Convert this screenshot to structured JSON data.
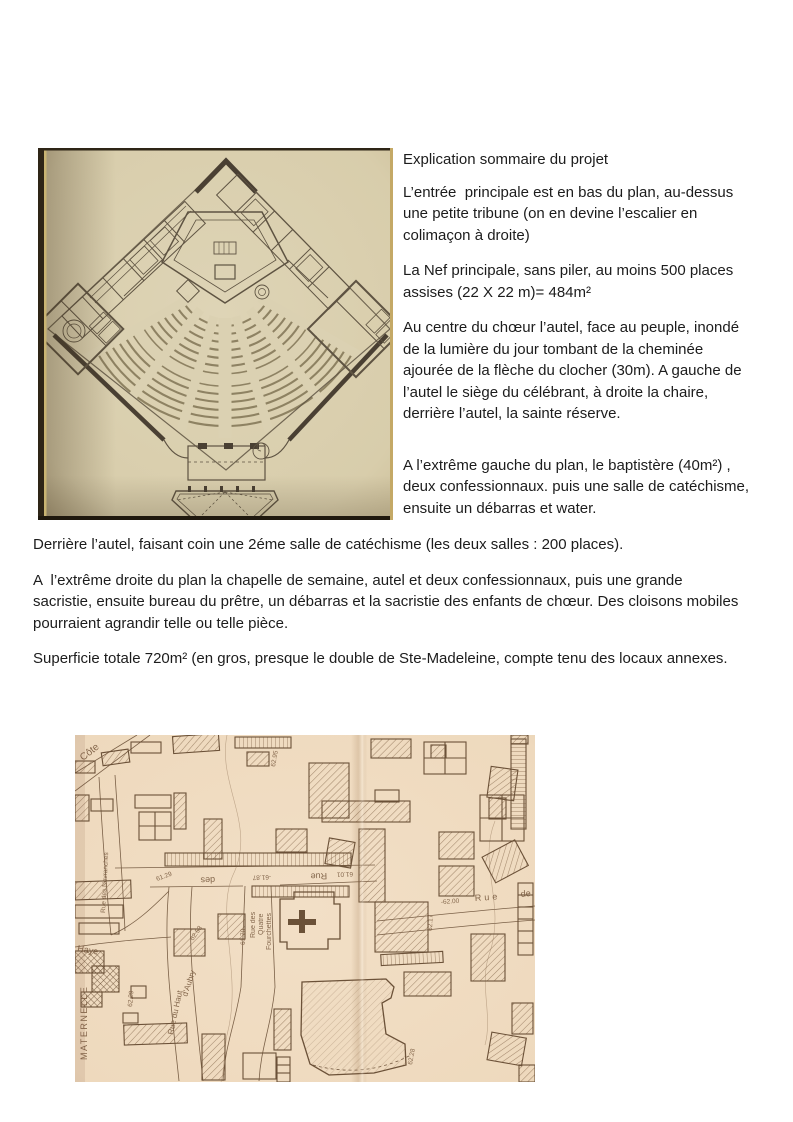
{
  "article": {
    "right_column": {
      "title": "Explication sommaire du projet",
      "paragraphs": [
        "L’entrée  principale est en bas du plan, au-dessus une petite tribune (on en devine l’escalier en colimaçon à droite)",
        "La Nef principale, sans piler, au moins 500 places assises (22 X 22 m)= 484m²",
        "Au centre du chœur l’autel, face au peuple, inondé de la lumière du jour tombant de la cheminée ajourée de la flèche du clocher (30m). A gauche de l’autel le siège du célébrant, à droite la chaire, derrière l’autel, la sainte réserve.",
        "A l’extrême gauche du plan, le baptistère (40m²) , deux confessionnaux. puis une salle de catéchisme, ensuite un débarras et water."
      ]
    },
    "full_width_paragraphs": [
      "Derrière l’autel, faisant coin une 2éme salle de catéchisme (les deux salles : 200 places).",
      "A  l’extrême droite du plan la chapelle de semaine, autel et deux confessionnaux, puis une grande sacristie, ensuite bureau du prêtre, un débarras et la sacristie des enfants de chœur. Des cloisons mobiles pourraient agrandir telle ou telle pièce.",
      "Superficie totale 720m² (en gros, presque le double de Ste-Madeleine, compte tenu des locaux annexes."
    ]
  },
  "plan_photo": {
    "paper_color": "#dbd1b2",
    "paper_edge_color": "#cdc09c",
    "ink_color": "#5e5342",
    "wall_color": "#4a4033",
    "edge_strip_color": "#2e2517",
    "accent_line_color": "#c9b472"
  },
  "map_photo": {
    "paper_color": "#f0ddc4",
    "paper_edge_color": "#e4ccad",
    "ink_color": "#6b5138",
    "label_color": "#7a5c41",
    "labels": [
      {
        "text": "Côte",
        "x": 8,
        "y": 26,
        "rot": -38,
        "size": 10
      },
      {
        "text": "Rue des Novranches",
        "x": 30,
        "y": 178,
        "rot": -87,
        "size": 6.5
      },
      {
        "text": "Haye",
        "x": 2,
        "y": 216,
        "rot": 10,
        "size": 9
      },
      {
        "text": "MATERNELLE",
        "x": 12,
        "y": 325,
        "rot": -90,
        "size": 9,
        "spacing": 1.5
      },
      {
        "text": "Rue du Haut",
        "x": 98,
        "y": 300,
        "rot": -78,
        "size": 8
      },
      {
        "text": "d’Aubry",
        "x": 112,
        "y": 262,
        "rot": -72,
        "size": 8
      },
      {
        "text": "62.29",
        "x": 57,
        "y": 272,
        "rot": -85,
        "size": 6.5
      },
      {
        "text": "62.53",
        "x": 118,
        "y": 206,
        "rot": -55,
        "size": 6.5
      },
      {
        "text": "61.29",
        "x": 82,
        "y": 146,
        "rot": -20,
        "size": 6.5
      },
      {
        "text": "des",
        "x": 140,
        "y": 142,
        "rot": 178,
        "size": 9
      },
      {
        "text": "-61.87",
        "x": 196,
        "y": 140,
        "rot": 178,
        "size": 6.5
      },
      {
        "text": "Rue",
        "x": 252,
        "y": 138,
        "rot": 178,
        "size": 9
      },
      {
        "text": "61.01",
        "x": 278,
        "y": 137,
        "rot": 178,
        "size": 6.5
      },
      {
        "text": "Rue des",
        "x": 180,
        "y": 203,
        "rot": -90,
        "size": 7
      },
      {
        "text": "Quatre",
        "x": 188,
        "y": 200,
        "rot": -90,
        "size": 7
      },
      {
        "text": "Fourchettes",
        "x": 196,
        "y": 215,
        "rot": -90,
        "size": 7
      },
      {
        "text": "61.70",
        "x": 170,
        "y": 210,
        "rot": -90,
        "size": 6.5
      },
      {
        "text": "62.95",
        "x": 200,
        "y": 32,
        "rot": -80,
        "size": 6.5
      },
      {
        "text": "-62.00",
        "x": 366,
        "y": 169,
        "rot": -4,
        "size": 6.5
      },
      {
        "text": "Rue",
        "x": 400,
        "y": 166,
        "rot": -4,
        "size": 9,
        "spacing": 3
      },
      {
        "text": "de",
        "x": 446,
        "y": 162,
        "rot": -6,
        "size": 9
      },
      {
        "text": "62.17",
        "x": 357,
        "y": 196,
        "rot": -88,
        "size": 6.5
      },
      {
        "text": "62.28",
        "x": 337,
        "y": 330,
        "rot": -80,
        "size": 6.5
      }
    ]
  }
}
